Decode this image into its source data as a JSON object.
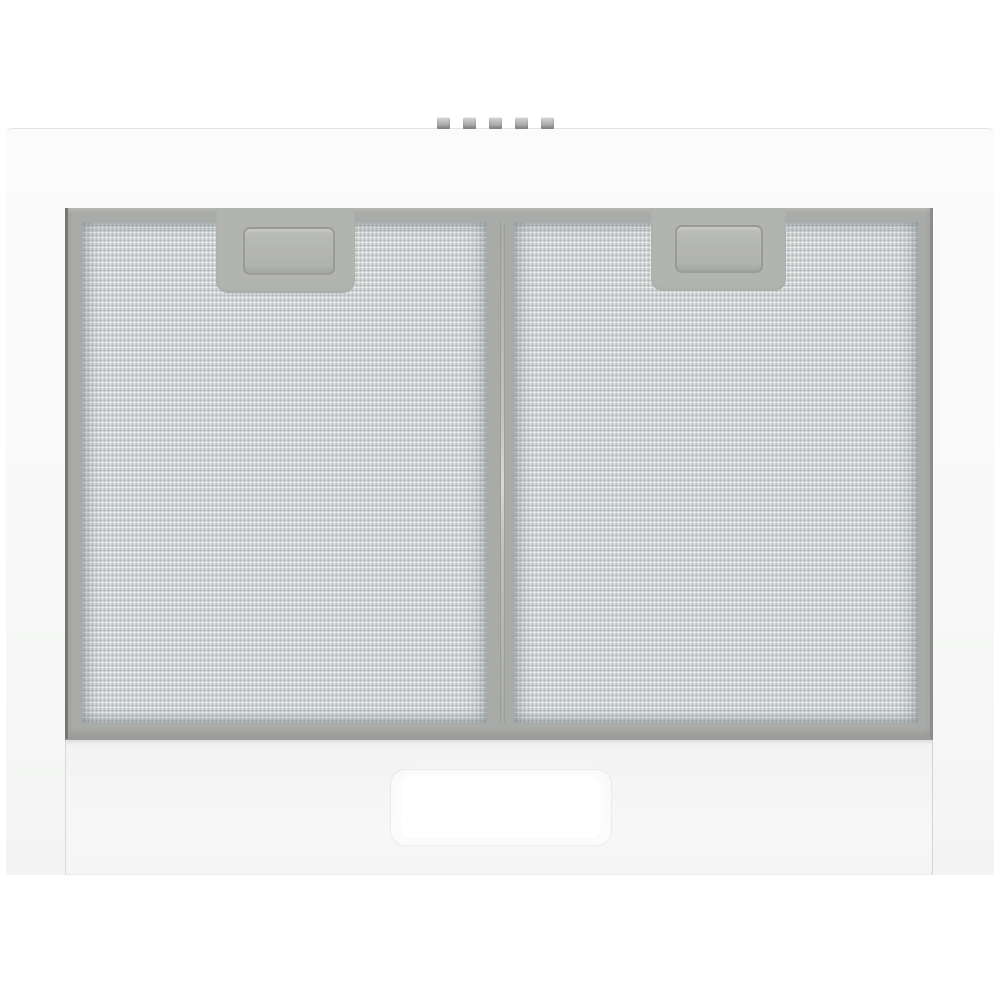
{
  "scene": {
    "description": "Bottom view of a white kitchen extractor hood: gray filter housing holding two aluminium mesh grease filters with recessed pull handles, a central divider seam, five small push-buttons along the top edge, and a lower white front panel with a rectangular lamp diffuser",
    "background_color": "#ffffff"
  },
  "colors": {
    "bg": "#ffffff",
    "body-top": "#fbfbfb",
    "body-mid": "#f8f9f8",
    "body-bottom": "#f3f4f3",
    "body-edge": "#e2e3e2",
    "housing": "#a9aba8",
    "housing-edge-left": "#757774",
    "housing-edge-right": "#8a8c89",
    "housing-edge-bottom": "#9a9c99",
    "mesh-base": "#cbd0d1",
    "mesh-shadow": "#7d878c",
    "mesh-highlight": "#f4f6f6",
    "notch": "#b2b4b0",
    "handle-border": "#83857f",
    "panel": "#f2f3f2",
    "panel-edge": "#d8dad8",
    "lamp": "#ffffff",
    "button-top": "#d8d8d8",
    "button-bottom": "#9c9c9c"
  },
  "hood": {
    "control_buttons": {
      "count": 5
    },
    "filters": {
      "count": 2,
      "items": [
        {
          "name": "left grease filter"
        },
        {
          "name": "right grease filter"
        }
      ]
    },
    "handles_per_filter": 1,
    "lamp": {
      "count": 1
    }
  }
}
